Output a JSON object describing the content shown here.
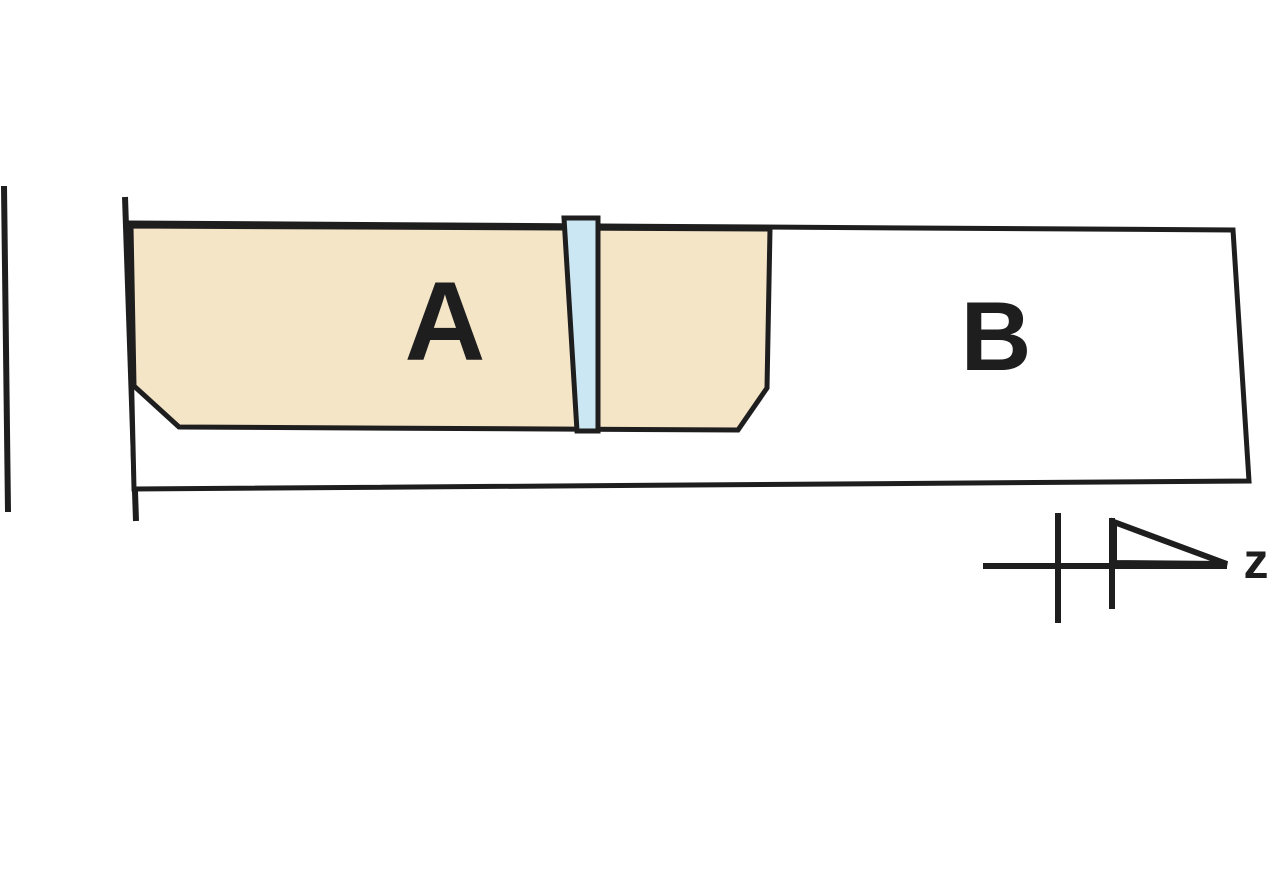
{
  "diagram": {
    "parcels": [
      {
        "label": "A",
        "fill": "#f5e5c7"
      },
      {
        "label": "B",
        "fill": "#ffffff"
      }
    ],
    "strip": {
      "fill": "#cbe7f3"
    },
    "north_indicator": {
      "label": "z"
    }
  },
  "colors": {
    "background": "#ffffff",
    "ink": "#1e1e1e"
  }
}
